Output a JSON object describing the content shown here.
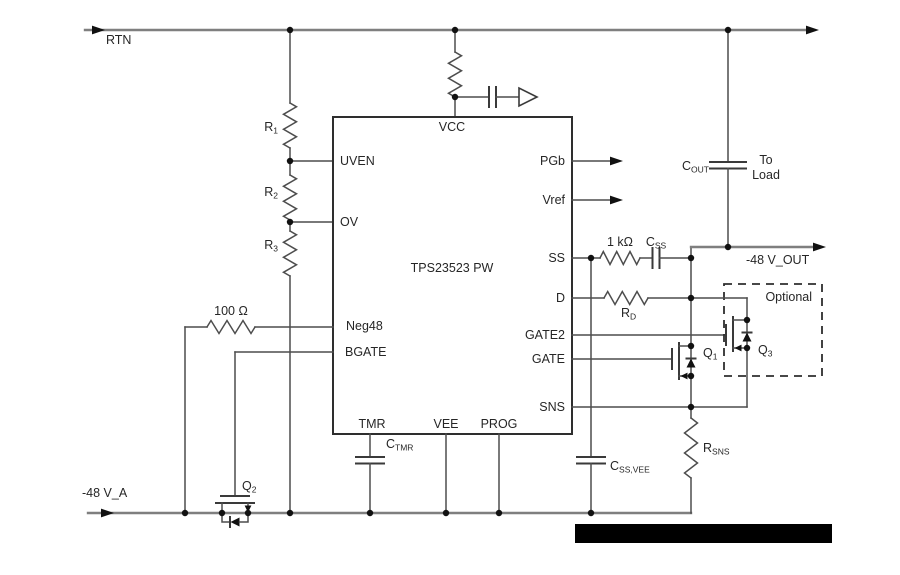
{
  "figure": {
    "type": "circuit-schematic",
    "description": "Hot-swap controller application circuit with redacted caption bar"
  },
  "rails": {
    "rtn": "RTN",
    "neg48_a": "-48 V_A",
    "neg48_out": "-48 V_OUT"
  },
  "ic": {
    "part": "TPS23523 PW",
    "pins": {
      "vcc": "VCC",
      "uven": "UVEN",
      "ov": "OV",
      "neg48": "Neg48",
      "bgate": "BGATE",
      "pgb": "PGb",
      "vref": "Vref",
      "ss": "SS",
      "d": "D",
      "gate2": "GATE2",
      "gate": "GATE",
      "sns": "SNS",
      "tmr": "TMR",
      "vee": "VEE",
      "prog": "PROG"
    }
  },
  "parts": {
    "r1": {
      "base": "R",
      "sub": "1"
    },
    "r2": {
      "base": "R",
      "sub": "2"
    },
    "r3": {
      "base": "R",
      "sub": "3"
    },
    "rd": {
      "base": "R",
      "sub": "D"
    },
    "rsns": {
      "base": "R",
      "sub": "SNS"
    },
    "css": {
      "base": "C",
      "sub": "SS"
    },
    "cout": {
      "base": "C",
      "sub": "OUT"
    },
    "ctmr": {
      "base": "C",
      "sub": "TMR"
    },
    "cssvee": {
      "base": "C",
      "sub": "SS,VEE"
    },
    "q1": {
      "base": "Q",
      "sub": "1"
    },
    "q2": {
      "base": "Q",
      "sub": "2"
    },
    "q3": {
      "base": "Q",
      "sub": "3"
    },
    "r100": "100 Ω",
    "r1k": "1 kΩ"
  },
  "annotations": {
    "optional": "Optional",
    "to_line1": "To",
    "to_line2": "Load"
  },
  "colors": {
    "wire": "#4d4d4d",
    "rail": "#7f7f7f",
    "ink": "#262626",
    "redaction": "#000000",
    "background": "#ffffff"
  }
}
